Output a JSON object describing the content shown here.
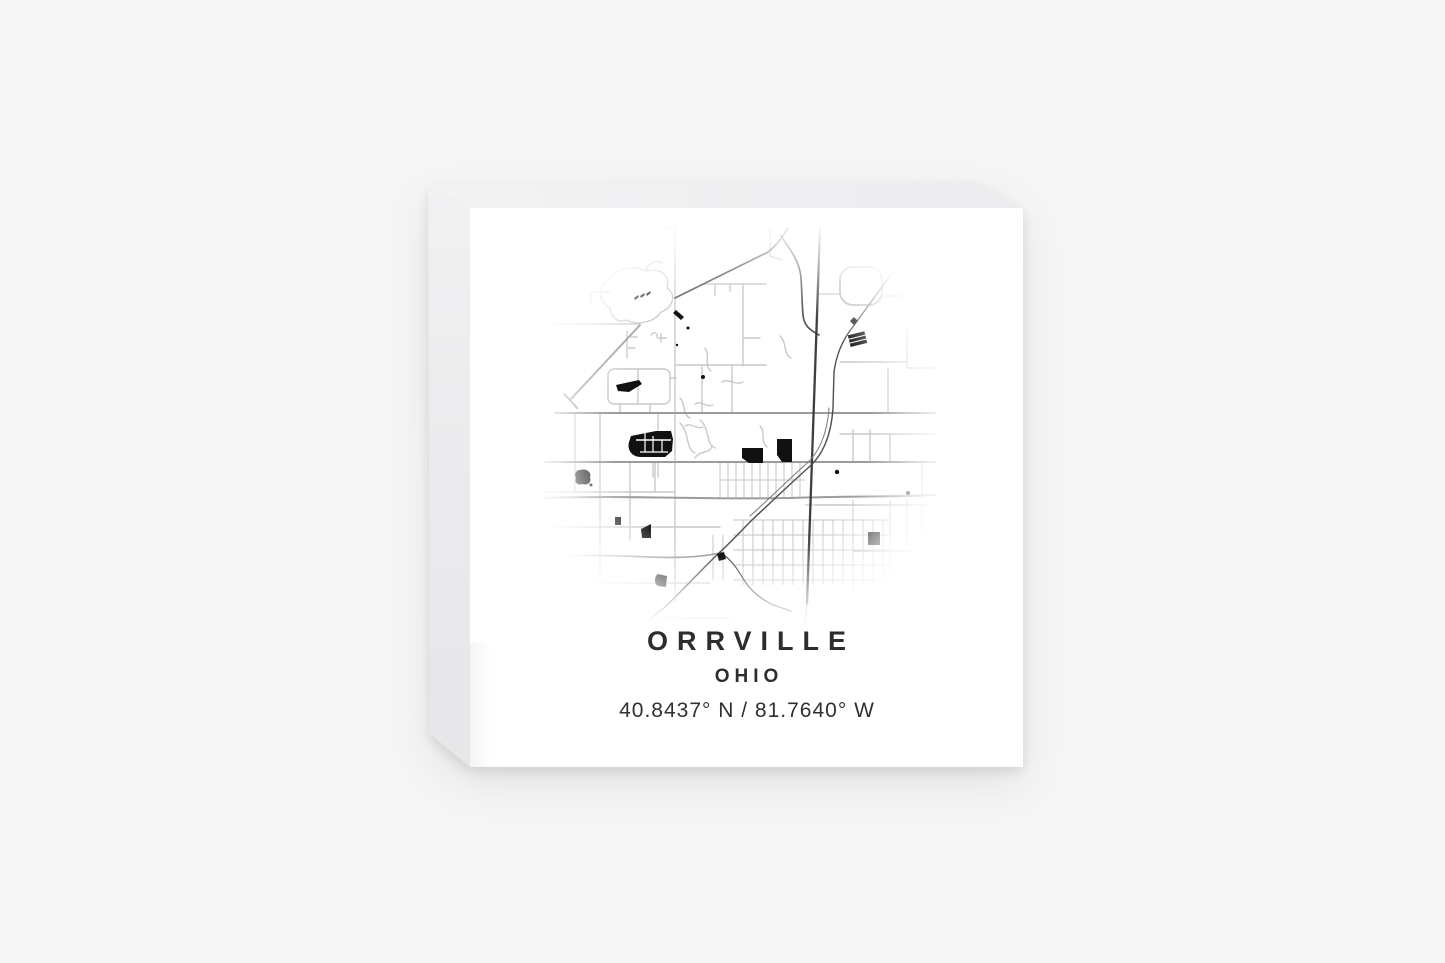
{
  "page": {
    "background_color": "#f6f6f7",
    "content": "product photo of a square white block with a minimalist city map print, viewed at a slight angle showing left and top sides"
  },
  "product": {
    "front_color": "#ffffff",
    "side_color": "#ebebed",
    "top_color": "#efeff1"
  },
  "print": {
    "city": "ORRVILLE",
    "state": "OHIO",
    "coordinates": "40.8437° N / 81.7640° W",
    "text_color": "#2d2d2d",
    "map": {
      "place": "Street map of Orrville, Ohio",
      "street_color": "#c9c9c9",
      "main_road_color": "#9c9c9c",
      "railroad_color": "#4f4f4f",
      "highway_color": "#5a5a5a",
      "building_color": "#111111"
    }
  }
}
